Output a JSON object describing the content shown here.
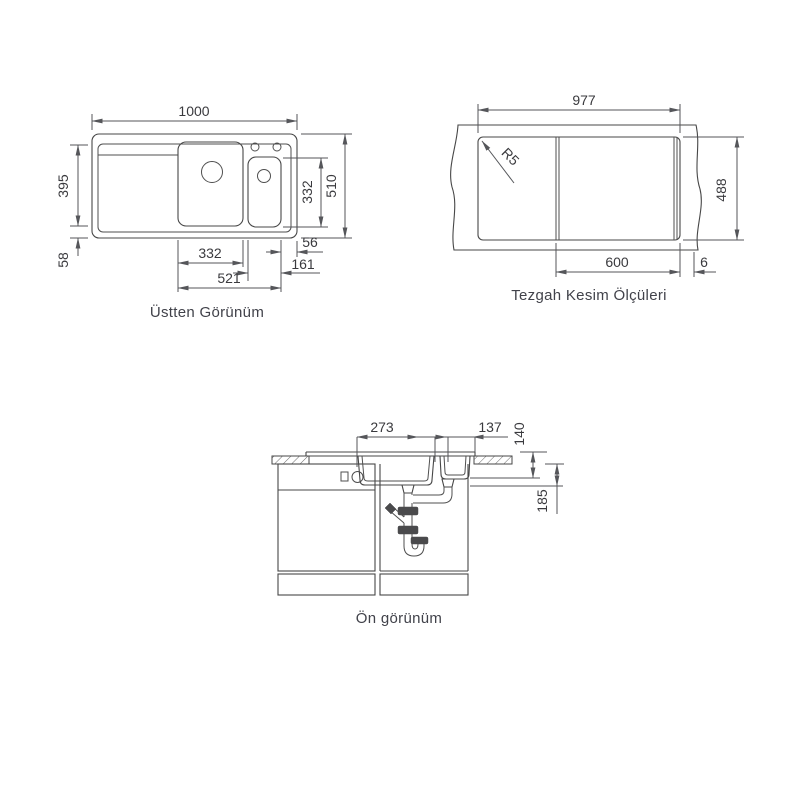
{
  "page": {
    "background": "#ffffff",
    "line_color": "#474747",
    "text_color": "#3a3a3e"
  },
  "top_view": {
    "caption": "Üstten Görünüm",
    "dims": {
      "overall_width": "1000",
      "overall_depth": "510",
      "right_bowl_depth": "332",
      "left_depth": "395",
      "left_bottom": "58",
      "main_bowl_width": "332",
      "right_edge_gap": "56",
      "small_bowl_width": "161",
      "bowls_span": "521"
    }
  },
  "cutout_view": {
    "caption": "Tezgah Kesim Ölçüleri",
    "dims": {
      "cut_width": "977",
      "cut_depth": "488",
      "cabinet_width": "600",
      "edge_offset": "6",
      "corner_radius": "R5"
    }
  },
  "front_view": {
    "caption": "Ön görünüm",
    "dims": {
      "main_drain_offset": "273",
      "small_drain_offset": "137",
      "depth_top": "140",
      "depth_drain": "185"
    }
  }
}
